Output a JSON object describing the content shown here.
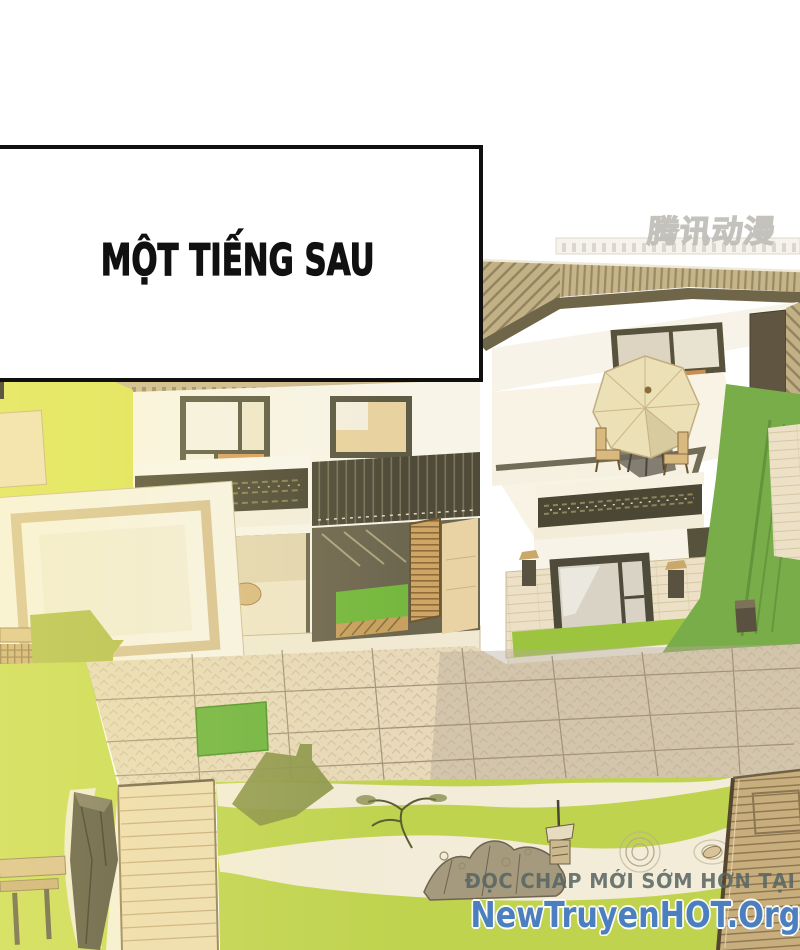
{
  "page": {
    "type": "comic-panel",
    "width": 800,
    "height": 950,
    "background": "#ffffff"
  },
  "caption": {
    "text": "MỘT TIẾNG SAU"
  },
  "publisher_watermark": {
    "text": "腾讯动漫"
  },
  "site_watermark": {
    "line1": "ĐỌC CHAP MỚI SỚM HƠN TẠI",
    "line2": "NewTruyenHOT.Org",
    "line1_color": "#586462",
    "line2_color": "#4c7fc0"
  },
  "colors": {
    "panel_border": "#101010",
    "lawn_left": "#dee455",
    "lawn_right": "#79ad49",
    "zen_lawn": "#bfd34f",
    "sand": "#f2ecd8",
    "roof": "#c6b48a",
    "roof_stripe": "#9a8a64",
    "eave": "#6f6549",
    "wall_white": "#f8f4e8",
    "frame_dark": "#57523c",
    "wood": "#cda263",
    "umbrella": "#ece0b6",
    "pavement": "#e7d9ba",
    "pavement_shade": "#b5aa98",
    "deck": "#c7ad7c",
    "green_patch": "#6db33f"
  },
  "scene": {
    "type": "isometric-house-illustration",
    "elements": [
      "striped hip roof",
      "rooftop terrace with parasol and chairs",
      "planter balcony railings",
      "open ground-floor lounge with sofa and pouf",
      "slatted wooden door",
      "stone-clad wall with picture window",
      "wall lanterns",
      "sunken lounge platform",
      "pergola",
      "herringbone paved courtyard",
      "green paving inset",
      "stepping-stone path",
      "zen garden with rocks, bonsai and raked sand",
      "sand ripples",
      "wooden deck"
    ]
  }
}
